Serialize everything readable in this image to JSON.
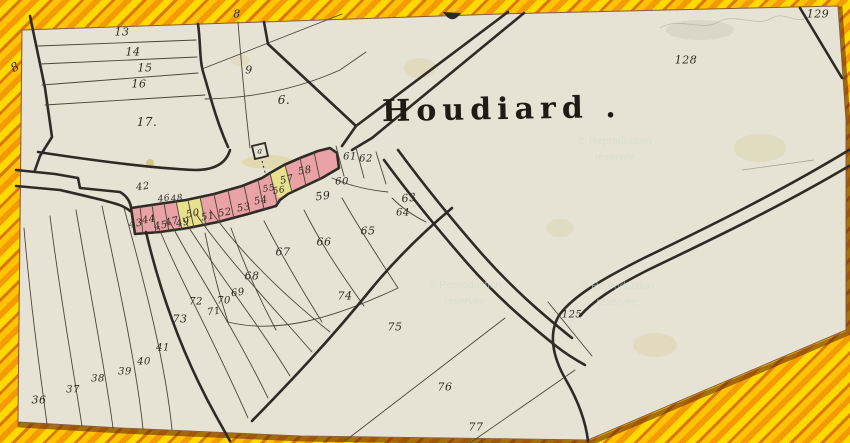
{
  "title": {
    "text": "Houdiard ."
  },
  "watermarks": {
    "line1": "Reproduction",
    "line2": "réservée",
    "positions": [
      {
        "x": 560,
        "y": 134
      },
      {
        "x": 410,
        "y": 278
      },
      {
        "x": 562,
        "y": 279
      }
    ]
  },
  "colors": {
    "paper": "#e7e3d4",
    "ink": "#2e2b25",
    "highlight_pink": "#e9a2a6",
    "highlight_yellow": "#e7e08c",
    "border_orange": "#f29b04",
    "border_yellow": "#ffd900",
    "border_deep": "#d97a08",
    "border_gold": "#ffc303"
  },
  "labels": [
    {
      "text": "8",
      "x": 237,
      "y": 14,
      "s": 11
    },
    {
      "text": "13",
      "x": 122,
      "y": 32
    },
    {
      "text": "14",
      "x": 133,
      "y": 52
    },
    {
      "text": "15",
      "x": 145,
      "y": 68
    },
    {
      "text": "16",
      "x": 139,
      "y": 84
    },
    {
      "text": "17.",
      "x": 147,
      "y": 122,
      "s": 12
    },
    {
      "text": "8",
      "x": 15,
      "y": 67,
      "rot": -30,
      "s": 12
    },
    {
      "text": "9",
      "x": 249,
      "y": 70
    },
    {
      "text": "6.",
      "x": 284,
      "y": 100,
      "s": 12
    },
    {
      "text": "129",
      "x": 818,
      "y": 14,
      "s": 11
    },
    {
      "text": "128",
      "x": 686,
      "y": 60,
      "s": 11
    },
    {
      "text": "42",
      "x": 143,
      "y": 187,
      "s": 10,
      "rot": -8
    },
    {
      "text": "43",
      "x": 136,
      "y": 224,
      "s": 10,
      "rot": -10
    },
    {
      "text": "44",
      "x": 149,
      "y": 220,
      "s": 10,
      "rot": -10
    },
    {
      "text": "45",
      "x": 161,
      "y": 226,
      "s": 10,
      "rot": -10
    },
    {
      "text": "46",
      "x": 164,
      "y": 199,
      "s": 9,
      "rot": -8
    },
    {
      "text": "48",
      "x": 177,
      "y": 199,
      "s": 9,
      "rot": -8
    },
    {
      "text": "47",
      "x": 172,
      "y": 222,
      "s": 10,
      "rot": -12
    },
    {
      "text": "49",
      "x": 183,
      "y": 223,
      "s": 10,
      "rot": -12
    },
    {
      "text": "50",
      "x": 193,
      "y": 214,
      "s": 10,
      "rot": -10
    },
    {
      "text": "51",
      "x": 208,
      "y": 217,
      "s": 10,
      "rot": -10
    },
    {
      "text": "52",
      "x": 225,
      "y": 213,
      "s": 10,
      "rot": -10
    },
    {
      "text": "53",
      "x": 244,
      "y": 208,
      "s": 10,
      "rot": -10
    },
    {
      "text": "54",
      "x": 261,
      "y": 201,
      "s": 10,
      "rot": -10
    },
    {
      "text": "55",
      "x": 269,
      "y": 189,
      "s": 9,
      "rot": -10
    },
    {
      "text": "56",
      "x": 279,
      "y": 191,
      "s": 9,
      "rot": -10
    },
    {
      "text": "57",
      "x": 287,
      "y": 180,
      "s": 10,
      "rot": -12
    },
    {
      "text": "58",
      "x": 305,
      "y": 171,
      "s": 10,
      "rot": -10
    },
    {
      "text": "a",
      "x": 260,
      "y": 151,
      "s": 8
    },
    {
      "text": "61",
      "x": 350,
      "y": 157,
      "s": 10
    },
    {
      "text": "62",
      "x": 366,
      "y": 159,
      "s": 10
    },
    {
      "text": "60",
      "x": 342,
      "y": 182,
      "s": 10
    },
    {
      "text": "59",
      "x": 323,
      "y": 196,
      "s": 11,
      "rot": -8
    },
    {
      "text": "63",
      "x": 409,
      "y": 198,
      "s": 11,
      "rot": -8
    },
    {
      "text": "64",
      "x": 403,
      "y": 213,
      "s": 10
    },
    {
      "text": "65",
      "x": 368,
      "y": 231,
      "s": 11
    },
    {
      "text": "66",
      "x": 324,
      "y": 242,
      "s": 11
    },
    {
      "text": "67",
      "x": 283,
      "y": 252,
      "s": 11
    },
    {
      "text": "68",
      "x": 252,
      "y": 276,
      "s": 11
    },
    {
      "text": "69",
      "x": 238,
      "y": 293,
      "s": 10,
      "rot": -8
    },
    {
      "text": "70",
      "x": 224,
      "y": 301,
      "s": 10
    },
    {
      "text": "71",
      "x": 214,
      "y": 312,
      "s": 10,
      "rot": -8
    },
    {
      "text": "72",
      "x": 196,
      "y": 302,
      "s": 10
    },
    {
      "text": "73",
      "x": 180,
      "y": 319,
      "s": 11
    },
    {
      "text": "74",
      "x": 345,
      "y": 296,
      "s": 11
    },
    {
      "text": "75",
      "x": 395,
      "y": 327,
      "s": 11
    },
    {
      "text": "76",
      "x": 445,
      "y": 387,
      "s": 11
    },
    {
      "text": "77",
      "x": 476,
      "y": 427,
      "s": 11
    },
    {
      "text": "125",
      "x": 572,
      "y": 315,
      "s": 10
    },
    {
      "text": "41",
      "x": 163,
      "y": 348,
      "s": 10
    },
    {
      "text": "40",
      "x": 144,
      "y": 362,
      "s": 10
    },
    {
      "text": "39",
      "x": 125,
      "y": 372,
      "s": 10
    },
    {
      "text": "38",
      "x": 98,
      "y": 379,
      "s": 10
    },
    {
      "text": "37",
      "x": 73,
      "y": 390,
      "s": 10
    },
    {
      "text": "36",
      "x": 39,
      "y": 400,
      "s": 11
    }
  ]
}
